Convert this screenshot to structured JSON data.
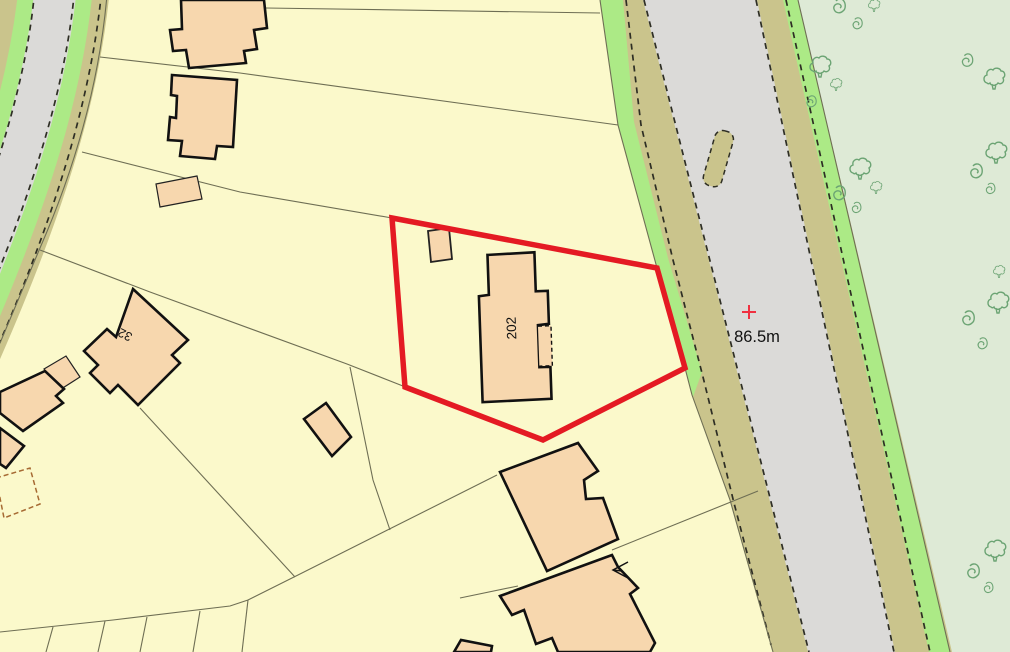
{
  "map": {
    "kind": "site-location-plan",
    "labels": {
      "main_plot_number": "202",
      "neighbor_plot_number": "32",
      "spot_height": "86.5m"
    },
    "boundary": {
      "color": "#E41A23",
      "vertices": [
        [
          392,
          218
        ],
        [
          657,
          268
        ],
        [
          685,
          368
        ],
        [
          543,
          440
        ],
        [
          405,
          387
        ]
      ]
    },
    "spot_height_marker": {
      "symbol": "red-cross",
      "value": "86.5m",
      "position": [
        749,
        312
      ]
    },
    "colors": {
      "parcel_fill": "#FBF9CB",
      "building_fill": "#F7D7AE",
      "building_outline": "#111111",
      "road_fill": "#DBDAD8",
      "verge_fill": "#CAC48C",
      "green_strip_fill": "#ACEA86",
      "woodland_fill": "#DEEAD6",
      "tree_symbol": "#6CA474",
      "boundary_red": "#E41A23",
      "parcel_line": "#6E6E54"
    },
    "features": {
      "roads": 2,
      "traffic_island": 1,
      "woodland_area": "right side with tree, bush and scrub symbols",
      "tree_symbols": 7,
      "scrub_symbols": 11,
      "bush_symbols": 4
    }
  }
}
